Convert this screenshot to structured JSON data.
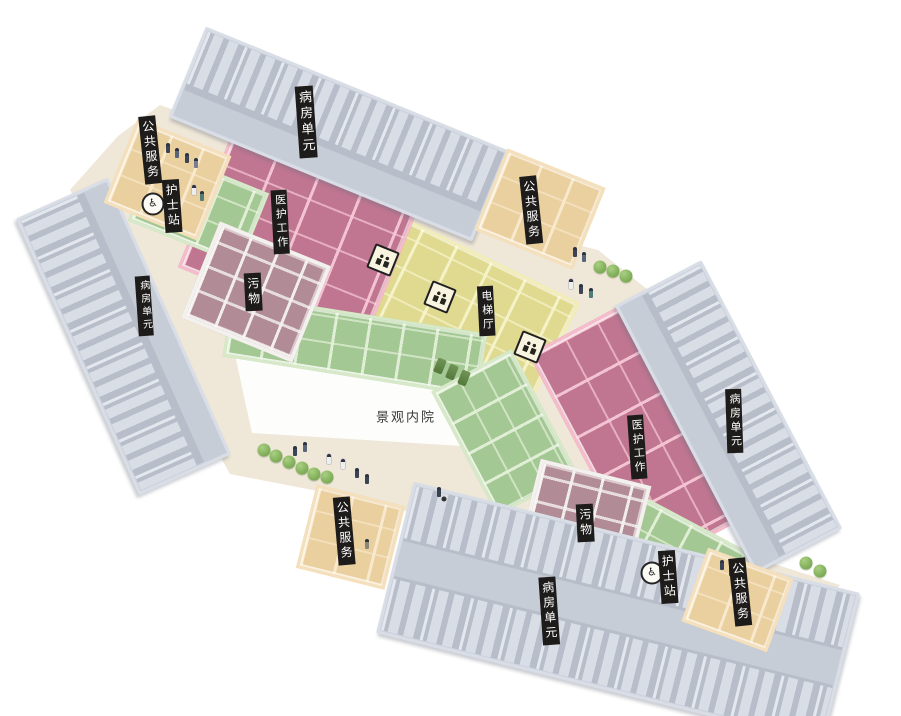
{
  "floor_plan": {
    "courtyard_label": "景观内院",
    "area_labels": {
      "ward_unit": "病房单元",
      "public_service": "公共服务",
      "nurse_station": "护士站",
      "medical_work": "医护工作",
      "medical_rest": "医护休息",
      "waste": "污物",
      "elevator_hall": "电梯厅"
    },
    "label_instances": [
      {
        "area": "ward_unit",
        "position": "top"
      },
      {
        "area": "ward_unit",
        "position": "left"
      },
      {
        "area": "ward_unit",
        "position": "right"
      },
      {
        "area": "ward_unit",
        "position": "bottom"
      },
      {
        "area": "public_service",
        "position": "top-left"
      },
      {
        "area": "public_service",
        "position": "top-right"
      },
      {
        "area": "public_service",
        "position": "bottom-left"
      },
      {
        "area": "public_service",
        "position": "bottom-right"
      },
      {
        "area": "nurse_station",
        "position": "top-left"
      },
      {
        "area": "nurse_station",
        "position": "bottom-right"
      },
      {
        "area": "medical_work",
        "position": "top"
      },
      {
        "area": "medical_work",
        "position": "right"
      },
      {
        "area": "waste",
        "position": "left"
      },
      {
        "area": "waste",
        "position": "bottom"
      },
      {
        "area": "elevator_hall",
        "position": "center"
      },
      {
        "area": "courtyard",
        "position": "center"
      }
    ],
    "icons": {
      "nurse_station_badge_glyph": "♿",
      "elevator_badge": "elevator-icon",
      "elevator_badge_count": 3,
      "nurse_badge_count": 2
    },
    "colors": {
      "background": "#ffffff",
      "ground": "#efe7d7",
      "courtyard": "#fdfdfc",
      "ward_wall": "#cdd3df",
      "ward_floor": "#b7bdc9",
      "public_service_wall": "#f4e0bd",
      "public_service_floor": "#eacf9f",
      "medical_work_wall": "#f5bccb",
      "medical_work_floor": "#c07690",
      "elevator_hall_wall": "#f2edbb",
      "elevator_hall_floor": "#e0da90",
      "medical_rest_wall": "#d7e9c9",
      "medical_rest_floor": "#a4c894",
      "waste_wall": "#f3f1ee",
      "waste_floor": "#b18b95",
      "label_background": "#1e1c1a",
      "label_text": "#ffffff",
      "courtyard_text": "#3a3a3a",
      "tree": "#7fae58"
    }
  }
}
